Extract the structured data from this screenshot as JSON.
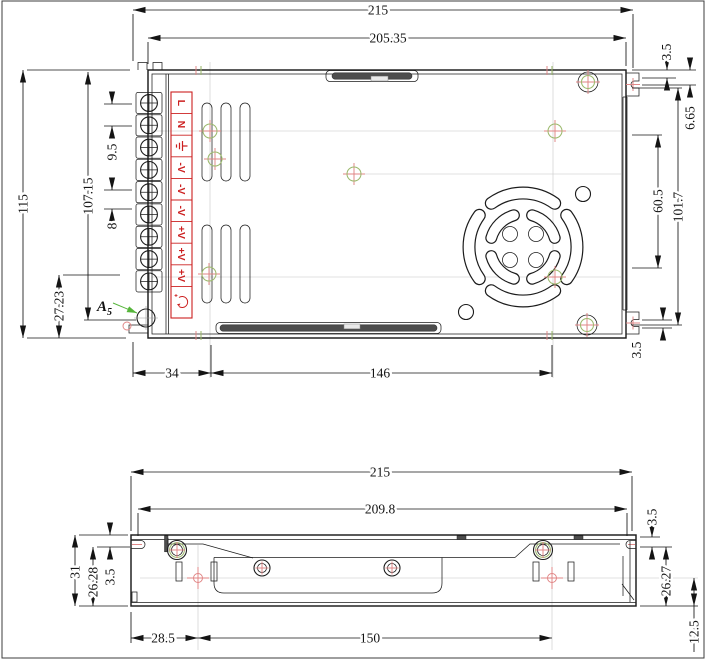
{
  "drawing_type": "engineering-dimension-drawing",
  "colors": {
    "line": "#1c1c1c",
    "label_red": "#cc2020",
    "marker_pink": "#e08484",
    "marker_green": "#9cb96d",
    "arrow_green": "#56b53b",
    "construction_gray": "#c6c6c6",
    "slot_dark": "#4d4d4d",
    "background": "#ffffff"
  },
  "top_view": {
    "dims": {
      "total_width": "215",
      "body_width": "205.35",
      "total_height": "115",
      "inner_height": "107.15",
      "terminal_pitch_ac": "9.5",
      "terminal_pitch_dc": "8",
      "corner_offset": "27.23",
      "hole_left_offset": "34",
      "hole_span": "146",
      "ear_top_offset": "3.5",
      "ear_center_offset": "6.65",
      "fan_panel_span": "60.5",
      "side_panel_span": "101.7",
      "ear_bottom_offset": "3.5"
    },
    "terminal_strip": {
      "labels": [
        "L",
        "N",
        "-V",
        "-V",
        "-V",
        "+V",
        "+V",
        "+V"
      ],
      "ground_icon": "earth-ground-icon",
      "adjust_icon": "output-voltage-adjust-icon"
    },
    "detail_marker": {
      "letter": "A",
      "subscript": "5"
    }
  },
  "side_view": {
    "dims": {
      "total_width": "215",
      "inner_width": "209.8",
      "total_height": "31",
      "slot_to_bottom_left": "26.28",
      "slot_top_left": "3.5",
      "hole_left_offset": "28.5",
      "hole_span": "150",
      "slot_top_right": "3.5",
      "slot_to_bottom_right": "26.27",
      "hole_to_bottom": "12.5"
    }
  },
  "icons": {
    "ground": "earth-ground-icon",
    "adjust": "output-voltage-adjust-icon",
    "leader": "green-leader-arrow",
    "screw": "cross-slot-screw-icon",
    "hole_marker": "drill-center-marker"
  }
}
